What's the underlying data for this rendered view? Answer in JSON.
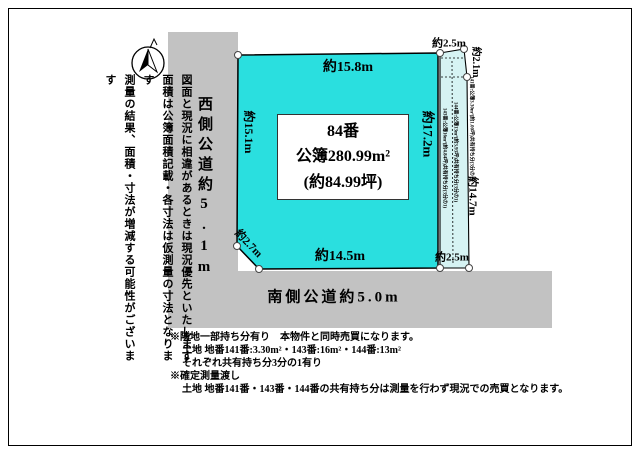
{
  "colors": {
    "plot_fill": "#2adfdf",
    "strip_fill": "#d6f3f3",
    "road_fill": "#c2c2c2",
    "outline": "#000000"
  },
  "disclaimer": {
    "col1": "図面と現況に相違があるときは現況優先といたします",
    "col2": "面積は公簿面積記載・各寸法は仮測量の寸法となります",
    "col3": "測量の結果、面積・寸法が増減する可能性がございます"
  },
  "roads": {
    "west_label": "西側公道約5.1m",
    "south_label": "南側公道約5.0m"
  },
  "plot": {
    "lot_number": "84番",
    "area_registered": "公簿280.99m²",
    "area_tsubo": "(約84.99坪)",
    "dim_top": "約15.8m",
    "dim_left": "約15.1m",
    "dim_right": "約17.2m",
    "dim_bottom": "約14.5m",
    "dim_corner_cut": "約2.7m"
  },
  "strip": {
    "dim_top": "約2.5m",
    "dim_top_diagonal": "約2.1m",
    "dim_right": "約14.7m",
    "dim_bottom": "約2.5m",
    "parcel_141": "141番:公簿3.30m²(約1.00坪)共有持ち分(3分の1)",
    "parcel_143": "143番:公簿16m²(約4.84坪)共有持ち分(3分の1)",
    "parcel_144": "144番:公簿13m²(約3.93坪)共有持ち分(3分の1)"
  },
  "notes": {
    "line1": "※隣地一部持ち分有り　本物件と同時売買になります。",
    "line2": "土地 地番141番:3.30m²・143番:16m²・144番:13m²",
    "line3": "それぞれ共有持ち分3分の1有り",
    "line4": "※確定測量渡し",
    "line5": "土地 地番141番・143番・144番の共有持ち分は測量を行わず現況での売買となります。"
  }
}
